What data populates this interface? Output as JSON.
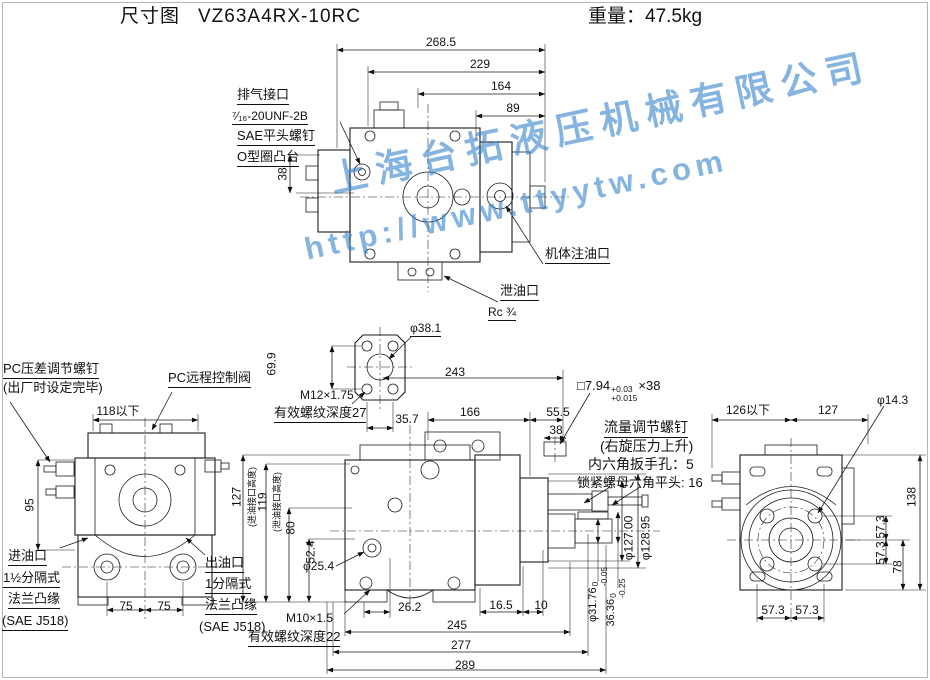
{
  "header": {
    "doc_type": "尺寸图",
    "model": "VZ63A4RX-10RC",
    "weight": "重量：47.5kg"
  },
  "watermark": {
    "company": "上海台拓液压机械有限公司",
    "url": "http://www.ttyytw.com",
    "color": "#3482cd"
  },
  "top_view": {
    "dim_268_5": "268.5",
    "dim_229": "229",
    "dim_164": "164",
    "dim_89": "89",
    "dim_38": "38",
    "callout_vent_port": "排气接口",
    "callout_vent_thread": "⁷⁄₁₆-20UNF-2B",
    "callout_sae_screw": "SAE平头螺钉",
    "callout_oring_boss": "O型圈凸台",
    "callout_body_fill_port": "机体注油口",
    "callout_drain_port": "泄油口",
    "callout_drain_thread": "Rc ¾"
  },
  "aux_flange_view": {
    "dim_phi_38_1": "φ38.1",
    "dim_69_9": "69.9",
    "thread_spec": "M12×1.75",
    "thread_depth": "有效螺纹深度27",
    "dim_35_7": "35.7",
    "dim_243": "243",
    "dim_166": "166",
    "dim_55_5": "55.5",
    "dim_38_key": "38"
  },
  "left_view": {
    "callout_pc_screw_line1": "PC压差调节螺钉",
    "callout_pc_screw_line2": "(出厂时设定完毕)",
    "callout_pc_valve": "PC远程控制阀",
    "dim_118_max": "118以下",
    "dim_95": "95",
    "dim_75_left": "75",
    "dim_75_right": "75",
    "inlet_line1": "进油口",
    "inlet_line2": "1½分隔式",
    "inlet_line3": "法兰凸缘",
    "inlet_line4": "(SAE J518)"
  },
  "front_view": {
    "dim_127": "127",
    "dim_127_note": "(进油接口高度)",
    "dim_119": "119",
    "dim_119_note": "(泄油接口高度)",
    "dim_80": "80",
    "dim_52_4": "52.4",
    "dim_phi_25_4": "φ25.4",
    "outlet_line1": "出油口",
    "outlet_line2": "1分隔式",
    "outlet_line3": "法兰凸缘",
    "outlet_line4": "(SAE J518)",
    "thread_spec": "M10×1.5",
    "thread_depth": "有效螺纹深度22",
    "dim_26_2": "26.2",
    "dim_16_5": "16.5",
    "dim_10": "10",
    "dim_245": "245",
    "dim_277": "277",
    "dim_289": "289",
    "dim_phi_127": "φ127.00",
    "dim_phi_128_95": "φ128.95",
    "shaft_dia": {
      "base": "φ31.76",
      "tol_upper": "0",
      "tol_lower": "-0.05"
    },
    "key_height": {
      "base": "36.36",
      "tol_upper": "0",
      "tol_lower": "-0.25"
    }
  },
  "key_spec": {
    "base": "□7.94",
    "tol_upper": "+0.03",
    "tol_lower": "+0.015",
    "suffix": "×38"
  },
  "flow_adjust": {
    "line1": "流量调节螺钉",
    "line2": "(右旋压力上升)",
    "line3": "内六角扳手孔：5",
    "line4": "锁紧螺母六角平头: 16"
  },
  "right_view": {
    "dim_126_max": "126以下",
    "dim_127": "127",
    "dim_phi_14_3": "φ14.3",
    "dim_138": "138",
    "dim_57_3_a": "57.3",
    "dim_57_3_b": "57.3",
    "dim_78": "78",
    "dim_57_3_c": "57.3",
    "dim_57_3_d": "57.3"
  }
}
